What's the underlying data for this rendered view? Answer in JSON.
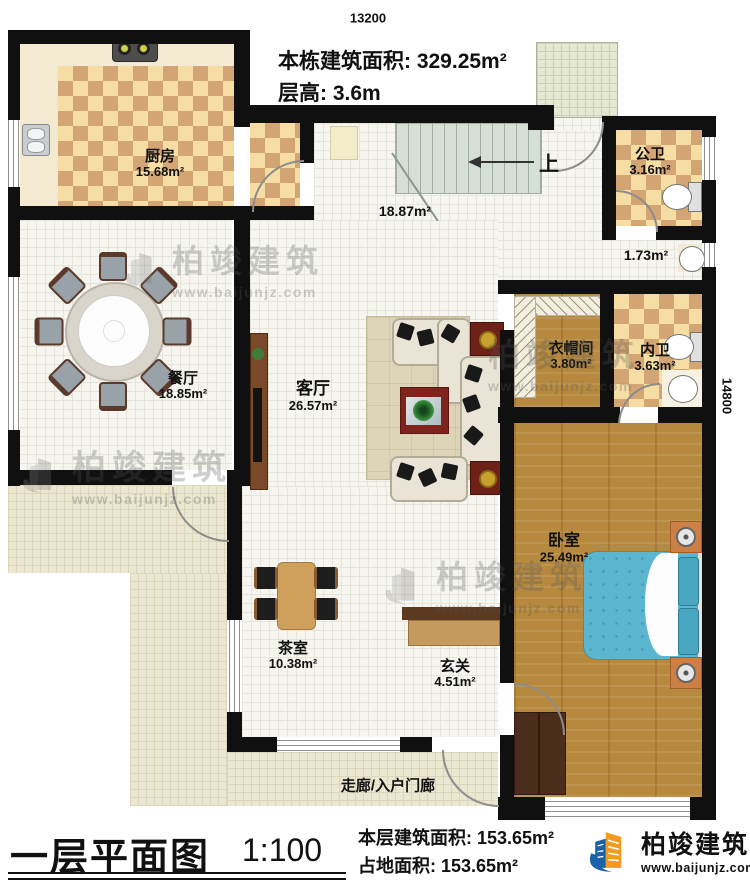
{
  "dimensions": {
    "top": "13200",
    "right": "14800"
  },
  "header": {
    "building_area": "本栋建筑面积: 329.25m²",
    "floor_height": "层高: 3.6m"
  },
  "rooms": {
    "kitchen": {
      "name": "厨房",
      "area": "15.68m²"
    },
    "public_bath": {
      "name": "公卫",
      "area": "3.16m²"
    },
    "stair_hall": {
      "area": "18.87m²"
    },
    "wash_corner": {
      "area": "1.73m²"
    },
    "dining": {
      "name": "餐厅",
      "area": "18.85m²"
    },
    "living": {
      "name": "客厅",
      "area": "26.57m²"
    },
    "cloakroom": {
      "name": "衣帽间",
      "area": "3.80m²"
    },
    "ensuite_bath": {
      "name": "内卫",
      "area": "3.63m²"
    },
    "bedroom": {
      "name": "卧室",
      "area": "25.49m²"
    },
    "tea_room": {
      "name": "茶室",
      "area": "10.38m²"
    },
    "foyer": {
      "name": "玄关",
      "area": "4.51m²"
    },
    "corridor": {
      "name": "走廊/入户门廊"
    }
  },
  "stairs": {
    "up": "上"
  },
  "footer": {
    "plan_title": "一层平面图",
    "scale": "1:100",
    "floor_area": "本层建筑面积: 153.65m²",
    "land_area": "占地面积: 153.65m²"
  },
  "brand": {
    "name": "柏竣建筑",
    "url": "www.baijunjz.com"
  },
  "watermark": {
    "name": "柏竣建筑",
    "url": "www.baijunjz.com"
  },
  "colors": {
    "logo_blue": "#1a63a8",
    "logo_orange": "#f29b1d",
    "wall": "#101010",
    "checker_light": "#f6dda4",
    "checker_dark": "#d3a575",
    "wood": "#b6893f",
    "bed_blue": "#5cb6cf",
    "outdoor": "#ece7d0"
  }
}
